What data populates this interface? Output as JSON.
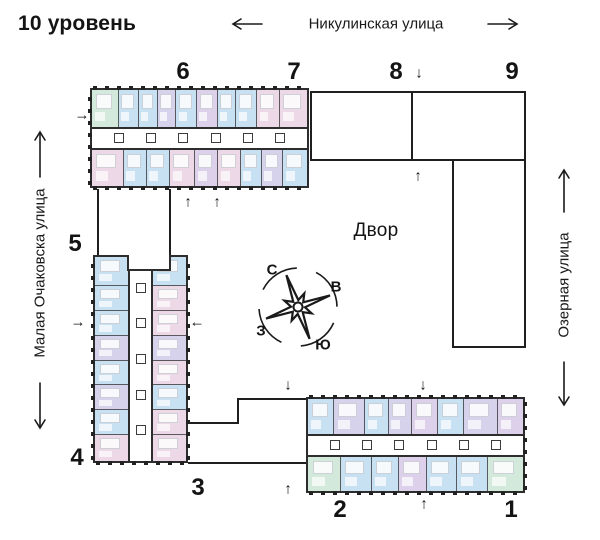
{
  "title": "10 уровень",
  "streets": {
    "top": "Никулинская улица",
    "left": "Малая Очаковска улица",
    "right": "Озерная улица"
  },
  "courtyard_label": "Двор",
  "compass": {
    "north": "С",
    "east": "В",
    "south": "Ю",
    "west": "З"
  },
  "icons": {
    "up": "↑",
    "down": "↓",
    "left": "←",
    "right": "→"
  },
  "section_labels": {
    "s1": "1",
    "s2": "2",
    "s3": "3",
    "s4": "4",
    "s5": "5",
    "s6": "6",
    "s7": "7",
    "s8": "8",
    "s9": "9"
  },
  "colors": {
    "blue": "#c7e0f2",
    "green": "#d2e9dc",
    "lavender": "#d7d2ec",
    "pink": "#ecd8e6",
    "violet": "#ddd0ea",
    "wall": "#2d2d2d",
    "outline": "#1f1f1f",
    "text": "#141414"
  },
  "buildings": {
    "top": {
      "name": "Секции 6–7",
      "corridor_boxes": 6,
      "top_cells": [
        {
          "c": "green",
          "f": 1.3
        },
        {
          "c": "blue",
          "f": 1
        },
        {
          "c": "blue",
          "f": 0.9
        },
        {
          "c": "lavender",
          "f": 0.9
        },
        {
          "c": "blue",
          "f": 1
        },
        {
          "c": "violet",
          "f": 1
        },
        {
          "c": "blue",
          "f": 0.9
        },
        {
          "c": "blue",
          "f": 1
        },
        {
          "c": "pink",
          "f": 1.1
        },
        {
          "c": "pink",
          "f": 1.4
        }
      ],
      "bottom_cells": [
        {
          "c": "pink",
          "f": 1.4
        },
        {
          "c": "blue",
          "f": 1
        },
        {
          "c": "blue",
          "f": 1
        },
        {
          "c": "pink",
          "f": 1.1
        },
        {
          "c": "violet",
          "f": 1
        },
        {
          "c": "pink",
          "f": 1
        },
        {
          "c": "blue",
          "f": 0.9
        },
        {
          "c": "lavender",
          "f": 0.9
        },
        {
          "c": "blue",
          "f": 1.1
        }
      ]
    },
    "left": {
      "name": "Секции 5–4",
      "corridor_boxes": 5,
      "left_cells": [
        {
          "c": "blue",
          "f": 1.2
        },
        {
          "c": "blue",
          "f": 1
        },
        {
          "c": "blue",
          "f": 1
        },
        {
          "c": "lavender",
          "f": 1
        },
        {
          "c": "blue",
          "f": 1
        },
        {
          "c": "lavender",
          "f": 1
        },
        {
          "c": "blue",
          "f": 1
        },
        {
          "c": "pink",
          "f": 1.1
        }
      ],
      "right_cells": [
        {
          "c": "blue",
          "f": 1.2
        },
        {
          "c": "pink",
          "f": 1
        },
        {
          "c": "pink",
          "f": 1
        },
        {
          "c": "lavender",
          "f": 1
        },
        {
          "c": "pink",
          "f": 1
        },
        {
          "c": "blue",
          "f": 1
        },
        {
          "c": "pink",
          "f": 1
        },
        {
          "c": "pink",
          "f": 1.1
        }
      ]
    },
    "bottom": {
      "name": "Секции 2–1",
      "corridor_boxes": 6,
      "top_cells": [
        {
          "c": "blue",
          "f": 1
        },
        {
          "c": "lavender",
          "f": 1.2
        },
        {
          "c": "blue",
          "f": 0.9
        },
        {
          "c": "lavender",
          "f": 0.9
        },
        {
          "c": "violet",
          "f": 1
        },
        {
          "c": "blue",
          "f": 1
        },
        {
          "c": "lavender",
          "f": 1.3
        },
        {
          "c": "violet",
          "f": 1
        }
      ],
      "bottom_cells": [
        {
          "c": "green",
          "f": 1.1
        },
        {
          "c": "blue",
          "f": 1
        },
        {
          "c": "blue",
          "f": 0.9
        },
        {
          "c": "violet",
          "f": 0.9
        },
        {
          "c": "blue",
          "f": 1
        },
        {
          "c": "blue",
          "f": 1
        },
        {
          "c": "green",
          "f": 1.2
        }
      ]
    }
  }
}
